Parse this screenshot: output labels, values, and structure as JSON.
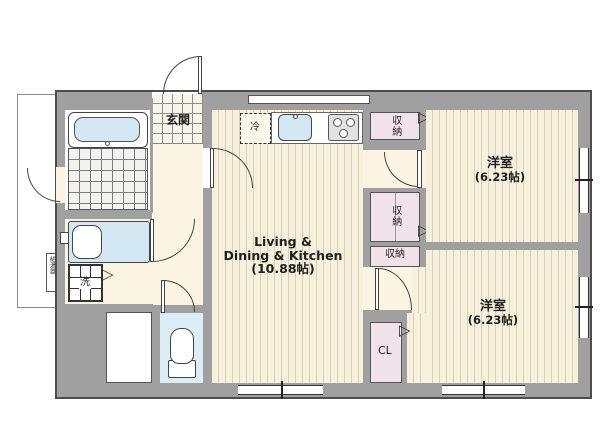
{
  "floorplan": {
    "living": {
      "line1": "Living &",
      "line2": "Dining & Kitchen",
      "line3": "(10.88帖)"
    },
    "bedroom_top": {
      "name": "洋室",
      "size": "(6.23帖)"
    },
    "bedroom_bottom": {
      "name": "洋室",
      "size": "(6.23帖)"
    },
    "entrance_label": "玄関",
    "fridge_label": "冷",
    "washer_label": "洗",
    "water_heater_label": "給湯器",
    "storage_top_label": "収納",
    "storage_mid_label": "収納",
    "storage_small_label": "収納",
    "closet_label": "CL",
    "icons": {
      "fold_door_right": "▷",
      "fold_door_down": "▽"
    },
    "colors": {
      "wall": "#a0a0a0",
      "outline": "#4d4d4d",
      "floor_base": "#f7f0dc",
      "floor_stripe": "#d9d0b5",
      "hall_floor": "#fbf4e3",
      "closet_fill": "#f2e3ea",
      "fixture_blue": "#d4e8f4",
      "toilet_floor": "#dcedf8"
    }
  }
}
